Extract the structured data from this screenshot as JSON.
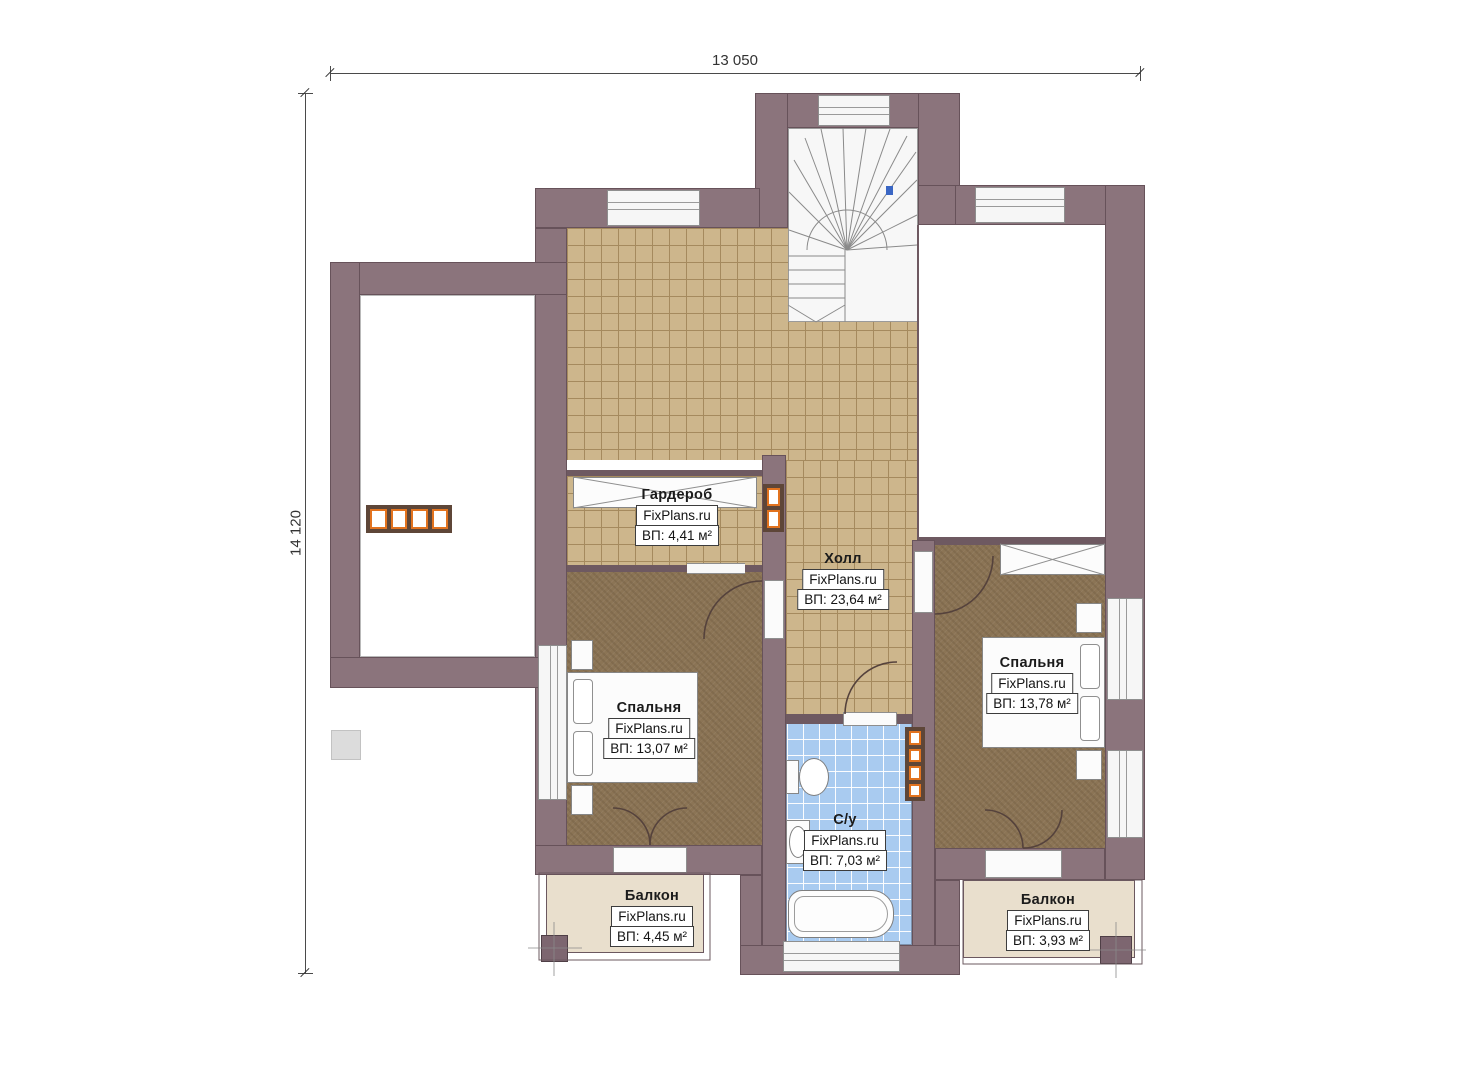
{
  "plan": {
    "watermark": "FixPlans.ru",
    "dimensions": {
      "width": "13 050",
      "height": "14 120"
    },
    "rooms": [
      {
        "key": "wardrobe",
        "name": "Гардероб",
        "site": "FixPlans.ru",
        "area": "ВП: 4,41 м²"
      },
      {
        "key": "hall",
        "name": "Холл",
        "site": "FixPlans.ru",
        "area": "ВП: 23,64 м²"
      },
      {
        "key": "bedroom-left",
        "name": "Спальня",
        "site": "FixPlans.ru",
        "area": "ВП: 13,07 м²"
      },
      {
        "key": "bedroom-right",
        "name": "Спальня",
        "site": "FixPlans.ru",
        "area": "ВП: 13,78 м²"
      },
      {
        "key": "bathroom",
        "name": "С/у",
        "site": "FixPlans.ru",
        "area": "ВП: 7,03 м²"
      },
      {
        "key": "balcony-left",
        "name": "Балкон",
        "site": "FixPlans.ru",
        "area": "ВП: 4,45 м²"
      },
      {
        "key": "balcony-right",
        "name": "Балкон",
        "site": "FixPlans.ru",
        "area": "ВП: 3,93 м²"
      }
    ],
    "colors": {
      "wall": "#8b747c",
      "tile": "#cdb68c",
      "bedroom_floor": "#8b7455",
      "bath_tile": "#a9cbf0",
      "balcony": "#e9dfcd",
      "radiator_accent": "#e2731f",
      "stair_marker": "#3a66c4"
    }
  }
}
